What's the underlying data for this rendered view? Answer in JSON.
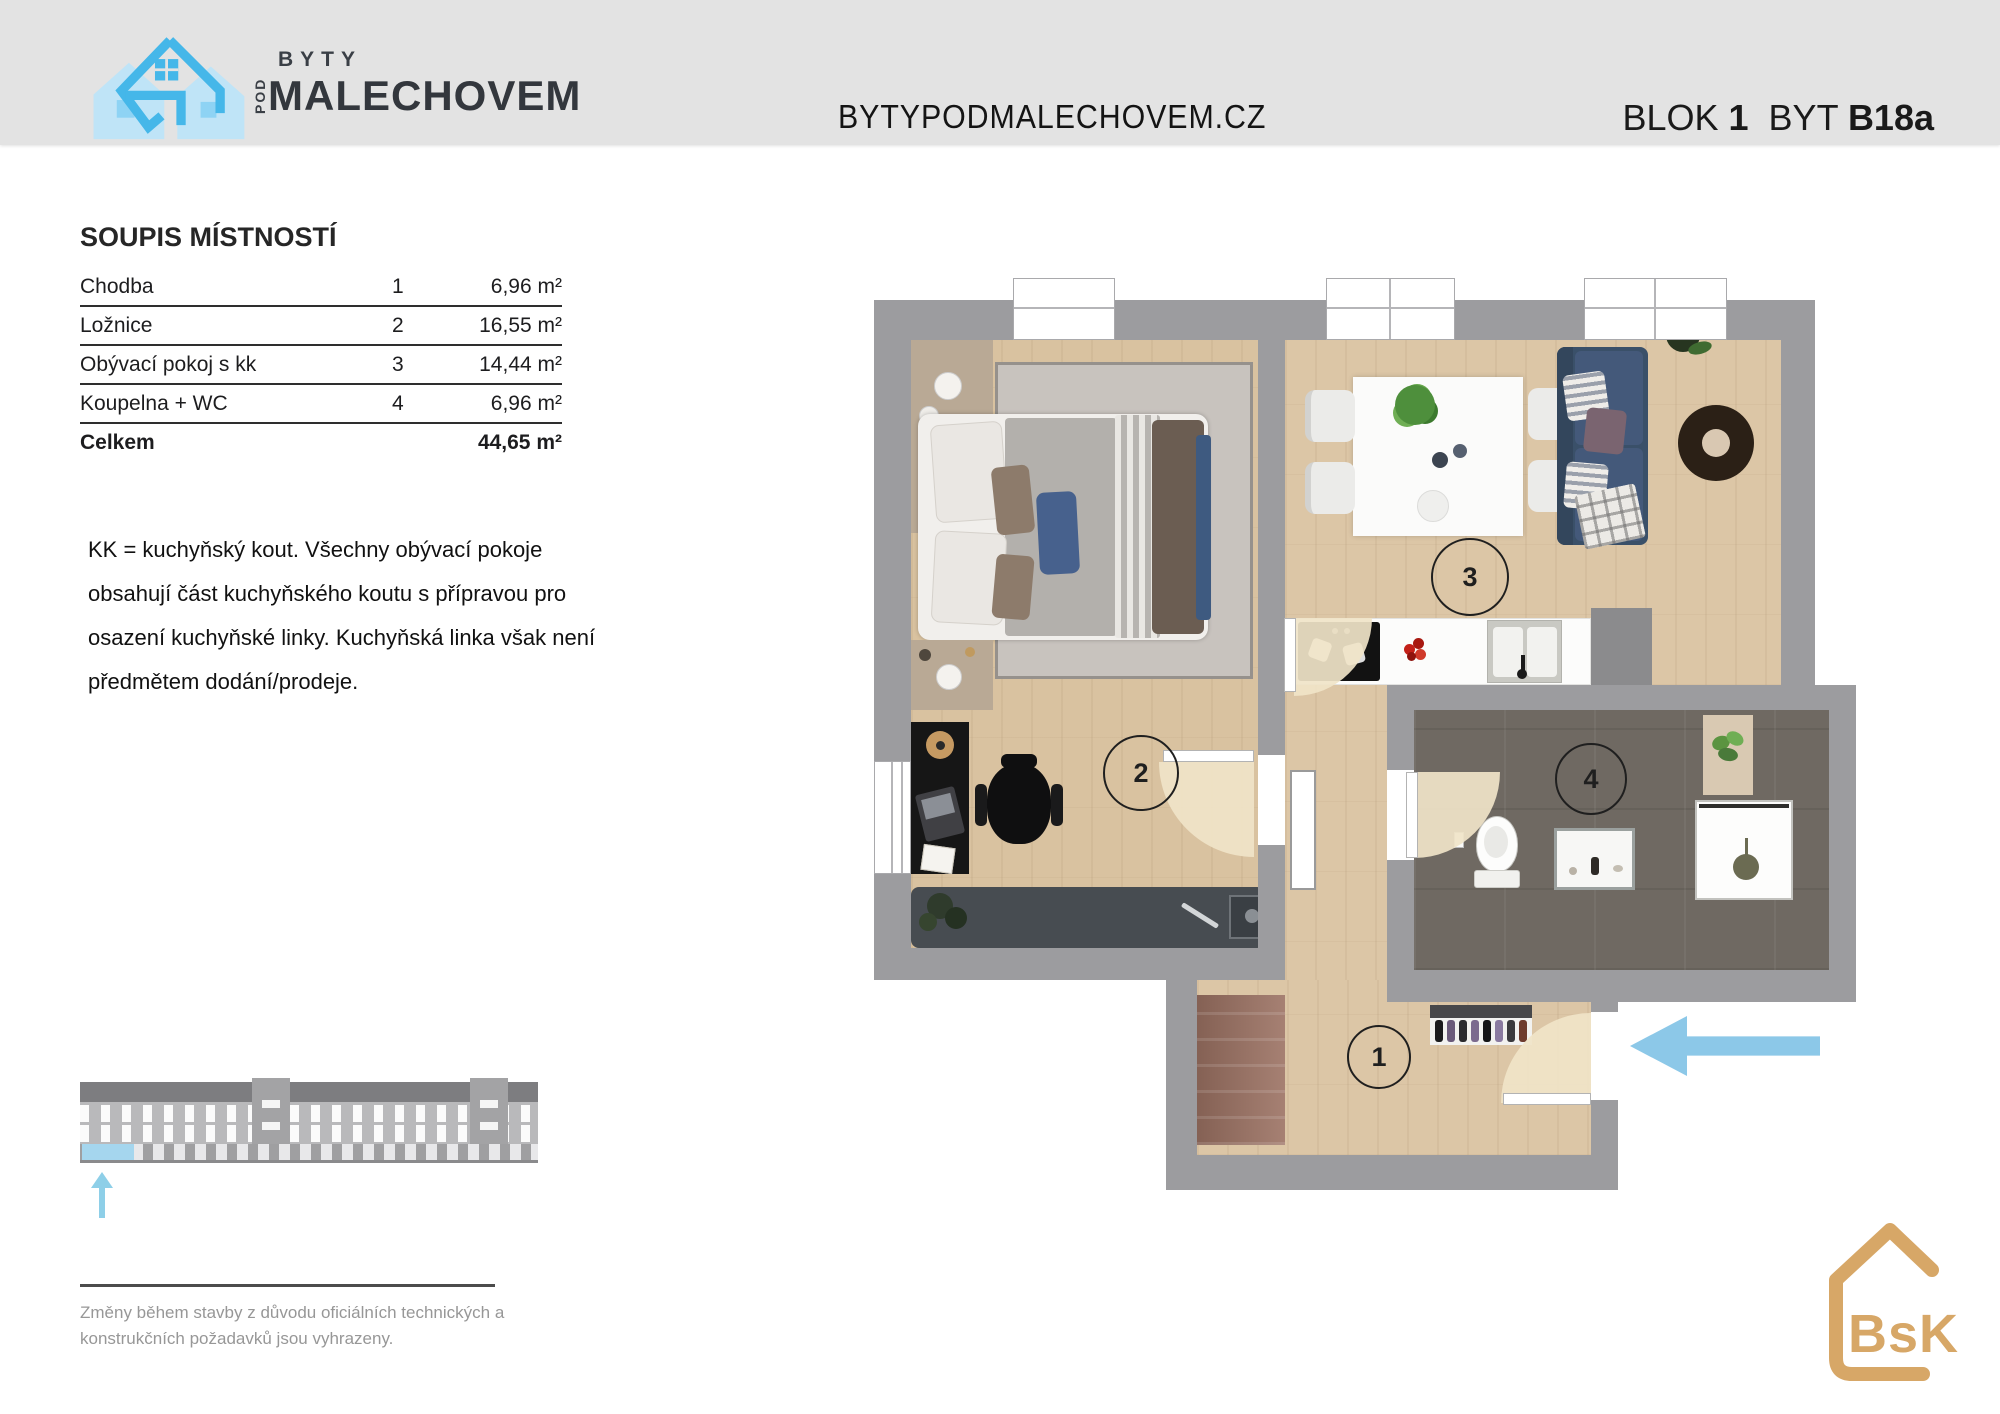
{
  "header": {
    "logo_byty": "BYTY",
    "logo_pod": "POD",
    "logo_name": "MALECHOVEM",
    "website": "BYTYPODMALECHOVEM.CZ",
    "blok_label": "BLOK",
    "blok_number": "1",
    "byt_label": "BYT",
    "byt_number": "B18a"
  },
  "room_list": {
    "title": "SOUPIS MÍSTNOSTÍ",
    "rows": [
      {
        "name": "Chodba",
        "number": "1",
        "area": "6,96 m²"
      },
      {
        "name": "Ložnice",
        "number": "2",
        "area": "16,55 m²"
      },
      {
        "name": "Obývací pokoj s kk",
        "number": "3",
        "area": "14,44 m²"
      },
      {
        "name": "Koupelna + WC",
        "number": "4",
        "area": "6,96 m²"
      }
    ],
    "total_label": "Celkem",
    "total_area": "44,65 m²"
  },
  "note_lines": [
    "KK = kuchyňský kout. Všechny obývací pokoje",
    "obsahují část kuchyňského koutu s přípravou pro",
    "osazení kuchyňské linky. Kuchyňská linka však není",
    "předmětem dodání/prodeje."
  ],
  "disclaimer_lines": [
    "Změny během stavby z důvodu oficiálních technických a",
    "konstrukčních požadavků jsou vyhrazeny."
  ],
  "floor_plan": {
    "rooms": [
      "1",
      "2",
      "3",
      "4"
    ]
  },
  "footer_logo": "BsK",
  "colors": {
    "accent_blue": "#45b7e9",
    "light_house_blue": "#bfe4f7",
    "entry_arrow_blue": "#8cc8e8",
    "bsk_gold": "#d7a767",
    "wall_gray": "#9c9c9f",
    "wood_floor": "#dcc6a6",
    "bath_floor": "#6f6962",
    "header_gray": "#e3e3e3"
  }
}
